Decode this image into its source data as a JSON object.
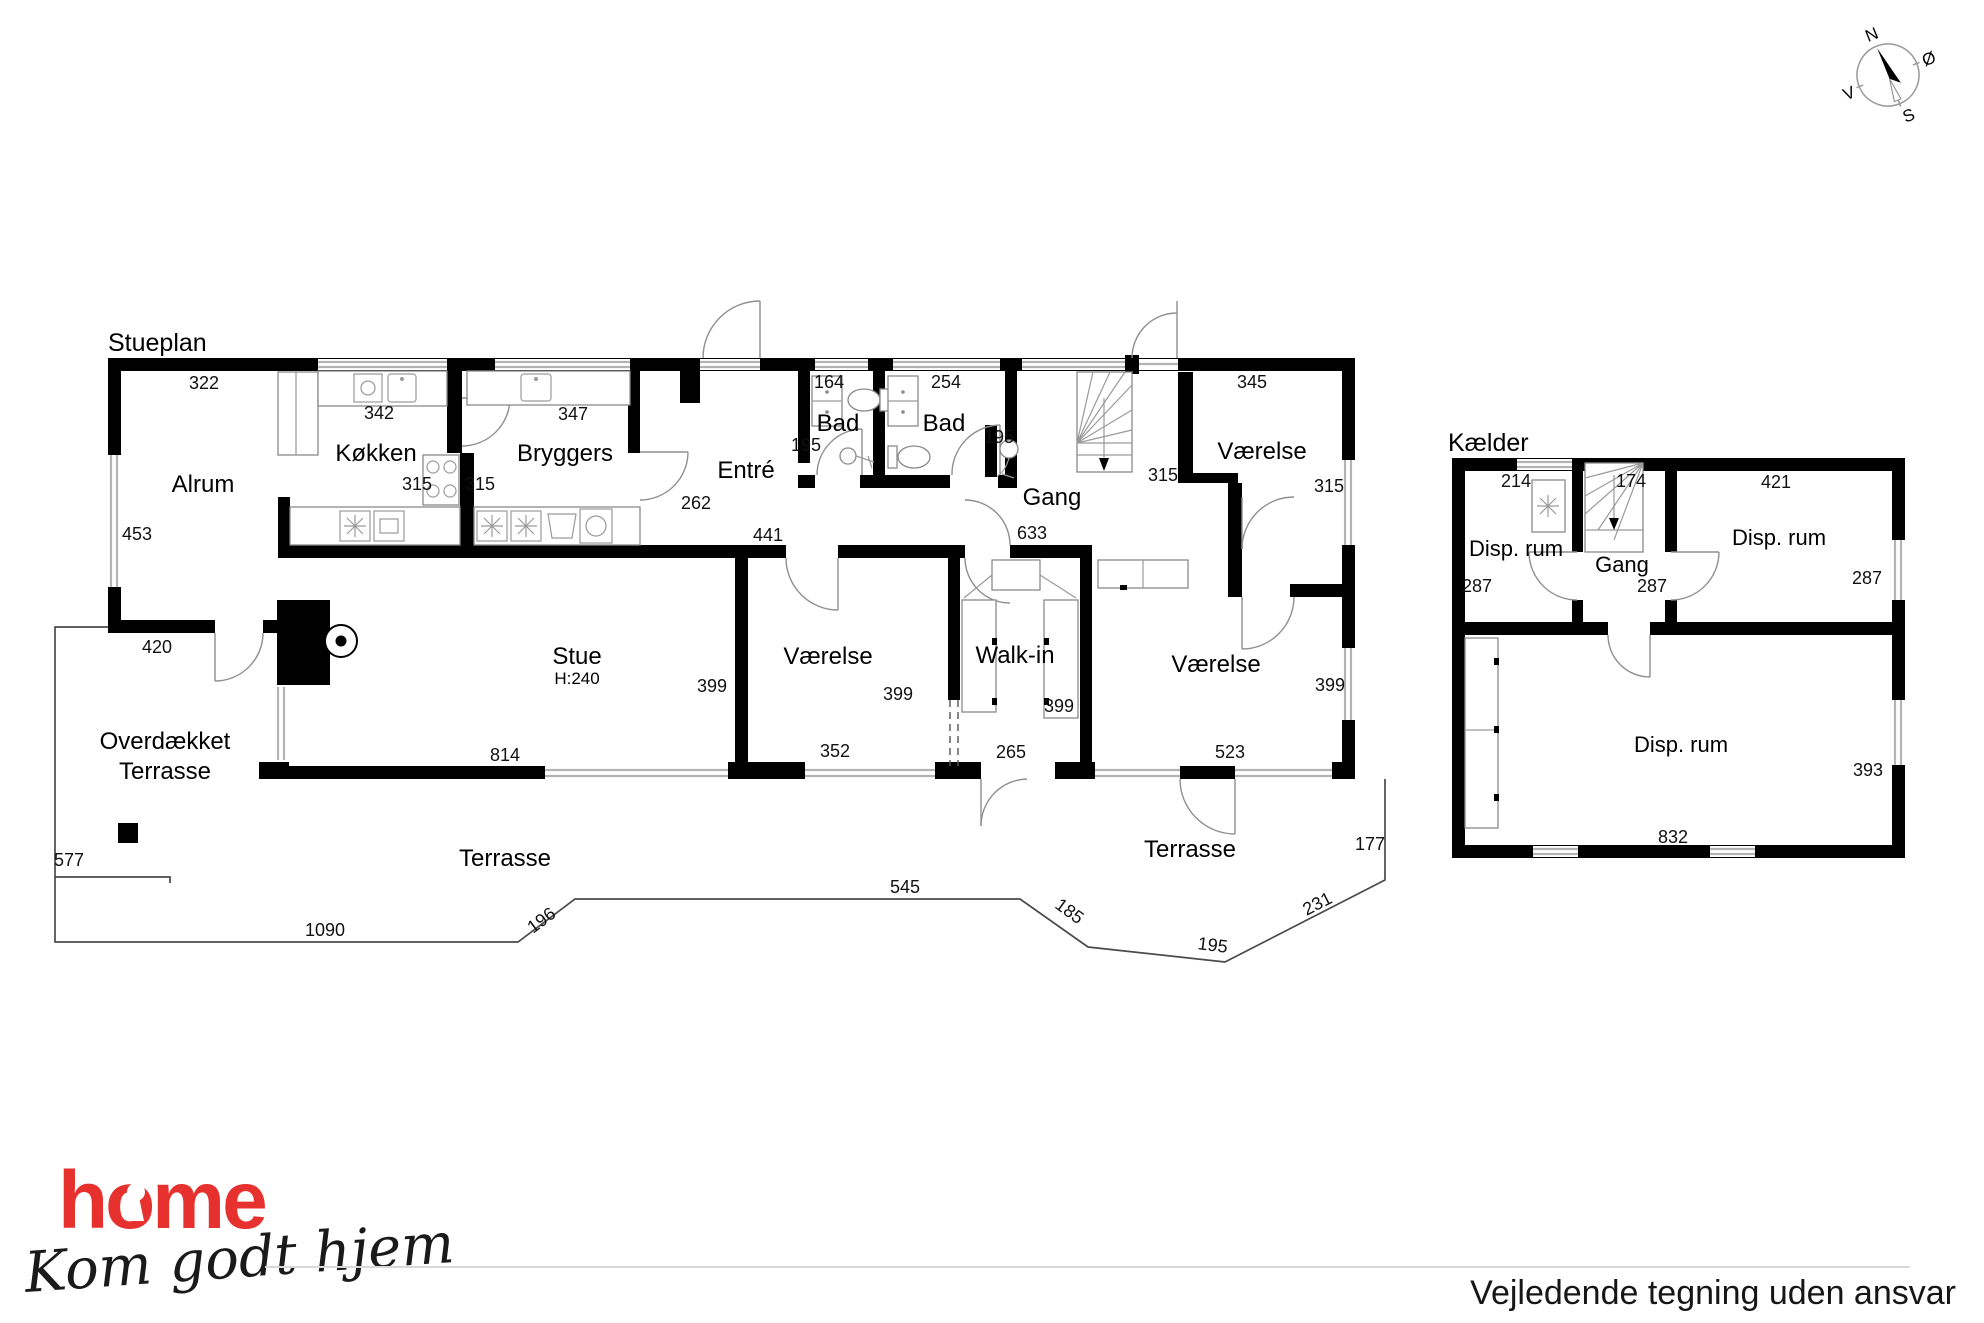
{
  "stueplan": {
    "title": "Stueplan",
    "rooms": {
      "alrum": "Alrum",
      "koekken": "Køkken",
      "bryggers": "Bryggers",
      "entre": "Entré",
      "bad1": "Bad",
      "bad2": "Bad",
      "gang": "Gang",
      "vaerelse_ne": "Værelse",
      "stue": "Stue",
      "stue_height": "H:240",
      "vaerelse_mid": "Værelse",
      "walkin": "Walk-in",
      "vaerelse_se": "Værelse",
      "overdaekket_line1": "Overdækket",
      "overdaekket_line2": "Terrasse",
      "terrasse_left": "Terrasse",
      "terrasse_right": "Terrasse"
    },
    "dims": {
      "alrum_width": "322",
      "alrum_depth": "453",
      "koekken_width": "342",
      "koekken_depth": "315",
      "bryggers_width": "347",
      "bryggers_depth": "315",
      "entre_depth": "262",
      "entre_width": "441",
      "bad1_width": "164",
      "bad1_depth": "195",
      "bad2_width": "254",
      "bad2_depth": "195",
      "gang_width": "633",
      "gang_depth": "315",
      "vaerelse_ne_width": "345",
      "vaerelse_ne_depth": "315",
      "overdaekket_width": "420",
      "overdaekket_depth": "577",
      "stue_width": "814",
      "stue_depth": "399",
      "vaerelse_mid_width": "352",
      "vaerelse_mid_depth": "399",
      "walkin_width": "265",
      "walkin_depth": "399",
      "vaerelse_se_width": "523",
      "vaerelse_se_depth": "399",
      "terrasse_edge_1090": "1090",
      "terrasse_edge_196": "196",
      "terrasse_edge_545": "545",
      "terrasse_edge_185": "185",
      "terrasse_edge_195": "195",
      "terrasse_edge_231": "231",
      "terrasse_edge_177": "177"
    }
  },
  "kaelder": {
    "title": "Kælder",
    "rooms": {
      "disp_rum_1": "Disp. rum",
      "gang": "Gang",
      "disp_rum_2": "Disp. rum",
      "disp_rum_3": "Disp. rum"
    },
    "dims": {
      "disp1_width": "214",
      "stairs_width": "174",
      "disp2_width": "421",
      "disp1_depth": "287",
      "gang_depth": "287",
      "disp2_depth": "287",
      "disp3_width": "832",
      "disp3_depth": "393"
    }
  },
  "compass": {
    "north": "N",
    "east": "Ø",
    "south": "S",
    "west": "V"
  },
  "footer": {
    "disclaimer": "Vejledende tegning uden ansvar"
  },
  "logo": {
    "brand": "home",
    "tagline": "Kom godt hjem",
    "brand_color": "#e6312e"
  }
}
